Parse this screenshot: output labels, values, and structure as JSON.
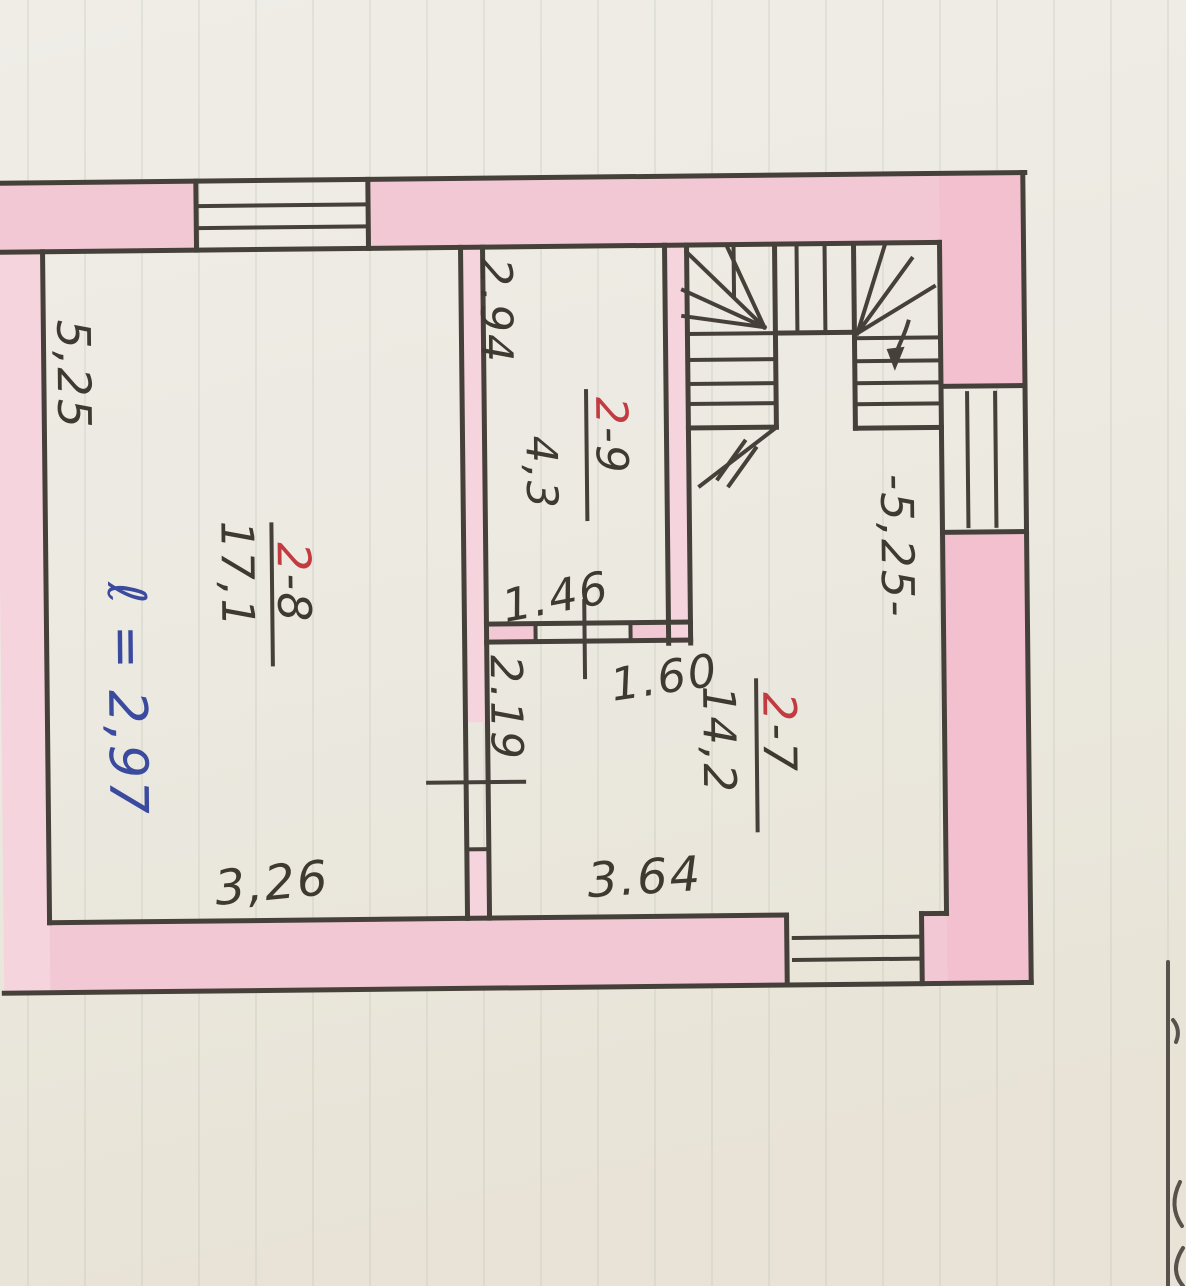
{
  "meta": {
    "description": "Hand-drawn floor plan sketch with pink-tinted walls, U-shaped winder staircase, window and door symbols, on faintly ruled paper",
    "paper_color": "#ECEAE2",
    "wall_fill_color": "#F3C8D5",
    "ink_color": "#46403A",
    "red_accent_color": "#C23B40",
    "blue_ink_color": "#3A4A9F"
  },
  "plan": {
    "rooms": [
      {
        "id": "2-8",
        "num_red": "2",
        "num_black": "-8",
        "area": "17,1"
      },
      {
        "id": "2-9",
        "num_red": "2",
        "num_black": "-9",
        "area": "4,3"
      },
      {
        "id": "2-7",
        "num_red": "2",
        "num_black": "-7",
        "area": "14,2"
      }
    ],
    "dimensions": {
      "left_wall_length": "5,25",
      "right_wall_length": "-5,25-",
      "room29_depth": "2.94",
      "door_width_146": "1.46",
      "opening_width_160": "1.60",
      "door_width_219": "2.19",
      "room28_width": "3,26",
      "hall_width": "3.64"
    },
    "note": {
      "blue_height_note": "ℓ = 2,97"
    },
    "elements": {
      "stairs": "u-shaped-winder-staircase",
      "windows": [
        "top-wall-window",
        "right-wall-window",
        "bottom-wall-window"
      ],
      "door_markers": [
        "door-146",
        "door-219"
      ]
    }
  }
}
